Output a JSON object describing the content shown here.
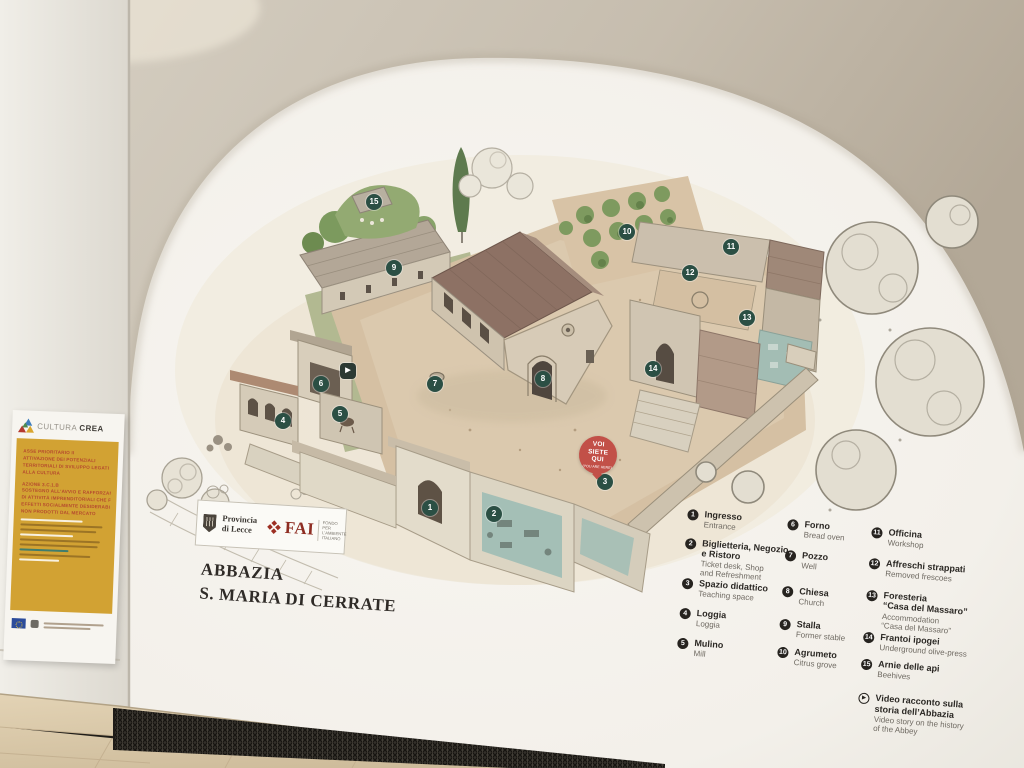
{
  "poster": {
    "brand_light": "CULTURA",
    "brand_bold": "CREA",
    "program_lines": [
      "ASSE PRIORITARIO II",
      "ATTIVAZIONE DEI POTENZIALI",
      "TERRITORIALI DI SVILUPPO LEGATI",
      "ALLA CULTURA",
      "AZIONE 3.C.1.B",
      "SOSTEGNO ALL'AVVIO E RAFFORZAMENTO",
      "DI ATTIVITÀ IMPRENDITORIALI CHE PRODUCONO",
      "EFFETTI SOCIALMENTE DESIDERABILI E BENI PUBBLICI",
      "NON PRODOTTI DAL MERCATO"
    ]
  },
  "plaque": {
    "provincia_line1": "Provincia",
    "provincia_line2": "di Lecce",
    "fai_name": "FAI",
    "fai_sub": "FONDO\nPER L'AMBIENTE\nITALIANO",
    "title_line1": "ABBAZIA",
    "title_line2": "S. MARIA DI CERRATE"
  },
  "you_are_here": {
    "label": "VOI\nSIETE\nQUI",
    "sub": "(YOU ARE HERE)"
  },
  "legend": {
    "columns": [
      {
        "items": [
          {
            "num": "1",
            "it": "Ingresso",
            "en": "Entrance"
          },
          {
            "num": "2",
            "it": "Biglietteria, Negozio\ne Ristoro",
            "en": "Ticket desk, Shop\nand Refreshment"
          },
          {
            "num": "3",
            "it": "Spazio didattico",
            "en": "Teaching space"
          },
          {
            "num": "4",
            "it": "Loggia",
            "en": "Loggia"
          },
          {
            "num": "5",
            "it": "Mulino",
            "en": "Mill"
          }
        ]
      },
      {
        "items": [
          {
            "num": "6",
            "it": "Forno",
            "en": "Bread oven"
          },
          {
            "num": "7",
            "it": "Pozzo",
            "en": "Well"
          },
          {
            "num": "8",
            "it": "Chiesa",
            "en": "Church"
          },
          {
            "num": "9",
            "it": "Stalla",
            "en": "Former stable"
          },
          {
            "num": "10",
            "it": "Agrumeto",
            "en": "Citrus grove"
          }
        ]
      },
      {
        "items": [
          {
            "num": "11",
            "it": "Officina",
            "en": "Workshop"
          },
          {
            "num": "12",
            "it": "Affreschi strappati",
            "en": "Removed frescoes"
          },
          {
            "num": "13",
            "it": "Foresteria\n“Casa del Massaro”",
            "en": "Accommodation\n“Casa del Massaro”"
          },
          {
            "num": "14",
            "it": "Frantoi ipogei",
            "en": "Underground olive-press"
          },
          {
            "num": "15",
            "it": "Arnie delle api",
            "en": "Beehives"
          },
          {
            "num": "video",
            "it": "Video racconto sulla\nstoria dell’Abbazia",
            "en": "Video story on the history\nof the Abbey"
          }
        ]
      }
    ]
  },
  "map": {
    "markers": [
      {
        "num": "1",
        "x": 430,
        "y": 508
      },
      {
        "num": "2",
        "x": 494,
        "y": 514
      },
      {
        "num": "3",
        "x": 605,
        "y": 482
      },
      {
        "num": "4",
        "x": 283,
        "y": 421
      },
      {
        "num": "5",
        "x": 340,
        "y": 414
      },
      {
        "num": "6",
        "x": 321,
        "y": 384
      },
      {
        "num": "7",
        "x": 435,
        "y": 384
      },
      {
        "num": "8",
        "x": 543,
        "y": 379
      },
      {
        "num": "9",
        "x": 394,
        "y": 268
      },
      {
        "num": "10",
        "x": 627,
        "y": 232
      },
      {
        "num": "11",
        "x": 731,
        "y": 247
      },
      {
        "num": "12",
        "x": 690,
        "y": 273
      },
      {
        "num": "13",
        "x": 747,
        "y": 318
      },
      {
        "num": "14",
        "x": 653,
        "y": 369
      },
      {
        "num": "15",
        "x": 374,
        "y": 202
      }
    ],
    "video_marker": {
      "x": 348,
      "y": 371,
      "glyph": "▶"
    }
  },
  "colors": {
    "marker_green": "#2b4f44",
    "badge_red": "#c25048",
    "poster_yellow": "#d2a233",
    "fai_red": "#9d2f23",
    "vault": "#c6bdae",
    "floor": "#d8c5a4"
  }
}
